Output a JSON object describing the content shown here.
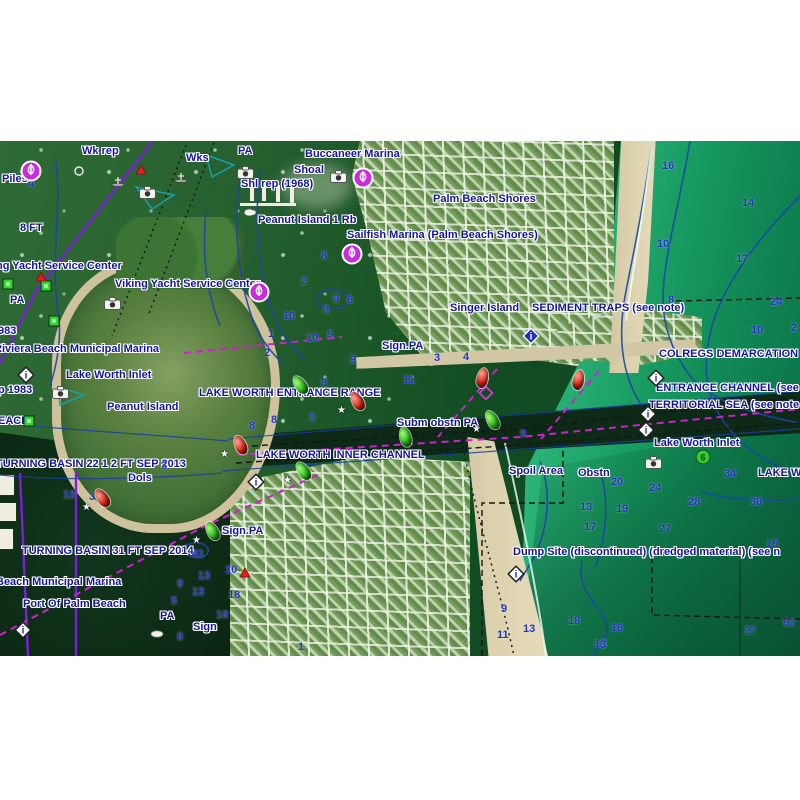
{
  "chart": {
    "colors": {
      "label_blue": "#15159a",
      "depth_blue": "#2334cb",
      "marina_magenta": "#c92ddb",
      "route_magenta": "#cf1fcf",
      "cable_purple": "#7b1fd6",
      "contour_blue": "#1b46a8",
      "buoy_green": "#2fc41f",
      "buoy_red": "#e92a1e",
      "ocean_green": "#16995f",
      "sand": "#d2c7a4"
    },
    "labels": [
      {
        "t": "Wk rep",
        "x": 82,
        "y": 5
      },
      {
        "t": "Piles",
        "x": 2,
        "y": 33
      },
      {
        "t": "Wks",
        "x": 186,
        "y": 12
      },
      {
        "t": "PA",
        "x": 238,
        "y": 5
      },
      {
        "t": "Shoal",
        "x": 294,
        "y": 24
      },
      {
        "t": "Shl rep (1968)",
        "x": 241,
        "y": 38
      },
      {
        "t": "Buccaneer Marina",
        "x": 305,
        "y": 8
      },
      {
        "t": "Palm Beach Shores",
        "x": 433,
        "y": 53
      },
      {
        "t": "Peanut Island 1 Rb",
        "x": 258,
        "y": 74
      },
      {
        "t": "Sailfish Marina (Palm Beach Shores)",
        "x": 347,
        "y": 89
      },
      {
        "t": "ng Yacht Service Center",
        "x": -4,
        "y": 120
      },
      {
        "t": "Viking Yacht Service Center",
        "x": 115,
        "y": 138
      },
      {
        "t": "PA",
        "x": 10,
        "y": 154
      },
      {
        "t": "8 FT",
        "x": 20,
        "y": 82
      },
      {
        "t": "983",
        "x": -2,
        "y": 185
      },
      {
        "t": "Riviera Beach Municipal Marina",
        "x": -6,
        "y": 203
      },
      {
        "t": "Lake Worth Inlet",
        "x": 66,
        "y": 229
      },
      {
        "t": "p 1983",
        "x": -2,
        "y": 244
      },
      {
        "t": "Peanut Island",
        "x": 107,
        "y": 261
      },
      {
        "t": "EACH",
        "x": -2,
        "y": 275
      },
      {
        "t": "TURNING BASIN 22 1 2 FT SEP 2013",
        "x": -4,
        "y": 318
      },
      {
        "t": "Dols",
        "x": 128,
        "y": 332
      },
      {
        "t": "Singer Island",
        "x": 450,
        "y": 162
      },
      {
        "t": "SEDIMENT TRAPS (see note)",
        "x": 532,
        "y": 162
      },
      {
        "t": "Sign.PA",
        "x": 382,
        "y": 200
      },
      {
        "t": "COLREGS DEMARCATION LINE",
        "x": 659,
        "y": 208
      },
      {
        "t": "LAKE WORTH ENTRANCE RANGE",
        "x": 199,
        "y": 247
      },
      {
        "t": "ENTRANCE CHANNEL (see note",
        "x": 656,
        "y": 242
      },
      {
        "t": "TERRITORIAL SEA (see note X)",
        "x": 649,
        "y": 259
      },
      {
        "t": "Subm obstn PA",
        "x": 397,
        "y": 277
      },
      {
        "t": "LAKE WORTH INNER CHANNEL",
        "x": 256,
        "y": 309
      },
      {
        "t": "Lake Worth Inlet",
        "x": 654,
        "y": 297
      },
      {
        "t": "Spoil Area",
        "x": 509,
        "y": 325
      },
      {
        "t": "Obstn",
        "x": 578,
        "y": 327
      },
      {
        "t": "LAKE WO",
        "x": 758,
        "y": 327
      },
      {
        "t": "Dump Site (discontinued) (dredged material) (see n",
        "x": 513,
        "y": 406
      },
      {
        "t": "Sign.PA",
        "x": 222,
        "y": 385
      },
      {
        "t": "TURNING BASIN 31 FT SEP 2014",
        "x": 22,
        "y": 405
      },
      {
        "t": "Beach Municipal Marina",
        "x": -4,
        "y": 436
      },
      {
        "t": "Port Of Palm Beach",
        "x": 23,
        "y": 458
      },
      {
        "t": "PA",
        "x": 160,
        "y": 470
      },
      {
        "t": "Sign",
        "x": 193,
        "y": 481
      }
    ],
    "depths": [
      {
        "v": "4",
        "x": 28,
        "y": 38
      },
      {
        "v": "16",
        "x": 662,
        "y": 20
      },
      {
        "v": "14",
        "x": 742,
        "y": 57
      },
      {
        "v": "10",
        "x": 657,
        "y": 98
      },
      {
        "v": "17",
        "x": 736,
        "y": 113
      },
      {
        "v": "8",
        "x": 668,
        "y": 154
      },
      {
        "v": "24",
        "x": 770,
        "y": 156
      },
      {
        "v": "10",
        "x": 751,
        "y": 184
      },
      {
        "v": "2",
        "x": 791,
        "y": 182
      },
      {
        "v": "8",
        "x": 321,
        "y": 110
      },
      {
        "v": "2",
        "x": 301,
        "y": 135
      },
      {
        "v": "9",
        "x": 333,
        "y": 153
      },
      {
        "v": "6",
        "x": 347,
        "y": 154
      },
      {
        "v": "3",
        "x": 323,
        "y": 164
      },
      {
        "v": "10",
        "x": 283,
        "y": 170
      },
      {
        "v": "10",
        "x": 306,
        "y": 192
      },
      {
        "v": "1",
        "x": 268,
        "y": 188
      },
      {
        "v": "2",
        "x": 264,
        "y": 207
      },
      {
        "v": "5",
        "x": 327,
        "y": 189
      },
      {
        "v": "3",
        "x": 434,
        "y": 212
      },
      {
        "v": "4",
        "x": 463,
        "y": 211
      },
      {
        "v": "9",
        "x": 350,
        "y": 214
      },
      {
        "v": "8",
        "x": 321,
        "y": 237
      },
      {
        "v": "11",
        "x": 403,
        "y": 234
      },
      {
        "v": "8",
        "x": 271,
        "y": 274
      },
      {
        "v": "3",
        "x": 309,
        "y": 272
      },
      {
        "v": "8",
        "x": 249,
        "y": 280
      },
      {
        "v": "9",
        "x": 520,
        "y": 288
      },
      {
        "v": "3",
        "x": 161,
        "y": 320
      },
      {
        "v": "12",
        "x": 63,
        "y": 349
      },
      {
        "v": "3",
        "x": 89,
        "y": 351
      },
      {
        "v": "41",
        "x": 192,
        "y": 408
      },
      {
        "v": "10",
        "x": 225,
        "y": 424
      },
      {
        "v": "13",
        "x": 198,
        "y": 430
      },
      {
        "v": "9",
        "x": 177,
        "y": 438
      },
      {
        "v": "13",
        "x": 192,
        "y": 446
      },
      {
        "v": "18",
        "x": 228,
        "y": 449
      },
      {
        "v": "5",
        "x": 171,
        "y": 455
      },
      {
        "v": "18",
        "x": 216,
        "y": 469
      },
      {
        "v": "8",
        "x": 177,
        "y": 491
      },
      {
        "v": "34",
        "x": 724,
        "y": 328
      },
      {
        "v": "20",
        "x": 611,
        "y": 336
      },
      {
        "v": "24",
        "x": 649,
        "y": 342
      },
      {
        "v": "28",
        "x": 688,
        "y": 356
      },
      {
        "v": "30",
        "x": 750,
        "y": 356
      },
      {
        "v": "13",
        "x": 580,
        "y": 361
      },
      {
        "v": "19",
        "x": 616,
        "y": 363
      },
      {
        "v": "17",
        "x": 584,
        "y": 381
      },
      {
        "v": "27",
        "x": 659,
        "y": 383
      },
      {
        "v": "15",
        "x": 766,
        "y": 398
      },
      {
        "v": "9",
        "x": 501,
        "y": 463
      },
      {
        "v": "13",
        "x": 523,
        "y": 483
      },
      {
        "v": "11",
        "x": 497,
        "y": 489
      },
      {
        "v": "18",
        "x": 568,
        "y": 475
      },
      {
        "v": "16",
        "x": 611,
        "y": 482
      },
      {
        "v": "13",
        "x": 594,
        "y": 498
      },
      {
        "v": "27",
        "x": 744,
        "y": 485
      },
      {
        "v": "62",
        "x": 783,
        "y": 477
      },
      {
        "v": "1",
        "x": 298,
        "y": 501
      },
      {
        "v": "3",
        "x": 600,
        "y": 499
      }
    ],
    "icons": [
      {
        "type": "marina",
        "x": 20,
        "y": 19
      },
      {
        "type": "marina",
        "x": 352,
        "y": 26
      },
      {
        "type": "marina",
        "x": 341,
        "y": 102
      },
      {
        "type": "marina",
        "x": 248,
        "y": 140
      },
      {
        "type": "camera",
        "x": 139,
        "y": 45
      },
      {
        "type": "camera",
        "x": 237,
        "y": 25
      },
      {
        "type": "camera",
        "x": 330,
        "y": 29
      },
      {
        "type": "camera",
        "x": 104,
        "y": 156
      },
      {
        "type": "camera",
        "x": 52,
        "y": 245
      },
      {
        "type": "camera",
        "x": 645,
        "y": 315
      },
      {
        "type": "diamond-i",
        "x": 15,
        "y": 223
      },
      {
        "type": "diamond-i",
        "x": 245,
        "y": 330
      },
      {
        "type": "diamond-i",
        "x": 645,
        "y": 226
      },
      {
        "type": "diamond-i",
        "x": 637,
        "y": 262
      },
      {
        "type": "diamond-i",
        "x": 635,
        "y": 278
      },
      {
        "type": "diamond-i",
        "x": 12,
        "y": 478
      },
      {
        "type": "diamond-i",
        "x": 505,
        "y": 422
      },
      {
        "type": "diamond-blue",
        "x": 520,
        "y": 184
      },
      {
        "type": "diamond-magenta",
        "x": 477,
        "y": 243
      },
      {
        "type": "green-square",
        "x": 2,
        "y": 137
      },
      {
        "type": "green-square",
        "x": 40,
        "y": 139
      },
      {
        "type": "green-square",
        "x": 48,
        "y": 174
      },
      {
        "type": "green-square",
        "x": 23,
        "y": 274
      },
      {
        "type": "red-triangle",
        "x": 135,
        "y": 23
      },
      {
        "type": "red-triangle",
        "x": 35,
        "y": 130
      },
      {
        "type": "red-triangle",
        "x": 239,
        "y": 426
      },
      {
        "type": "wreck",
        "x": 110,
        "y": 35
      },
      {
        "type": "wreck",
        "x": 173,
        "y": 31
      },
      {
        "type": "boat",
        "x": 242,
        "y": 67
      },
      {
        "type": "circle",
        "x": 74,
        "y": 25
      },
      {
        "type": "oyster",
        "x": 150,
        "y": 489
      },
      {
        "type": "can-green",
        "x": 695,
        "y": 308,
        "label": "6"
      }
    ],
    "buoys": [
      {
        "c": "red",
        "x": 352,
        "y": 250,
        "r": -30,
        "star": true
      },
      {
        "c": "red",
        "x": 477,
        "y": 227,
        "r": 12,
        "star": false
      },
      {
        "c": "red",
        "x": 573,
        "y": 229,
        "r": 12,
        "star": false
      },
      {
        "c": "red",
        "x": 235,
        "y": 294,
        "r": -25,
        "star": true
      },
      {
        "c": "red",
        "x": 97,
        "y": 347,
        "r": -35,
        "star": true
      },
      {
        "c": "green",
        "x": 295,
        "y": 234,
        "r": -35,
        "star": false
      },
      {
        "c": "green",
        "x": 487,
        "y": 269,
        "r": -30,
        "star": true
      },
      {
        "c": "green",
        "x": 400,
        "y": 286,
        "r": -15,
        "star": false
      },
      {
        "c": "green",
        "x": 298,
        "y": 320,
        "r": -35,
        "star": true
      },
      {
        "c": "green",
        "x": 207,
        "y": 380,
        "r": -30,
        "star": true
      }
    ]
  }
}
